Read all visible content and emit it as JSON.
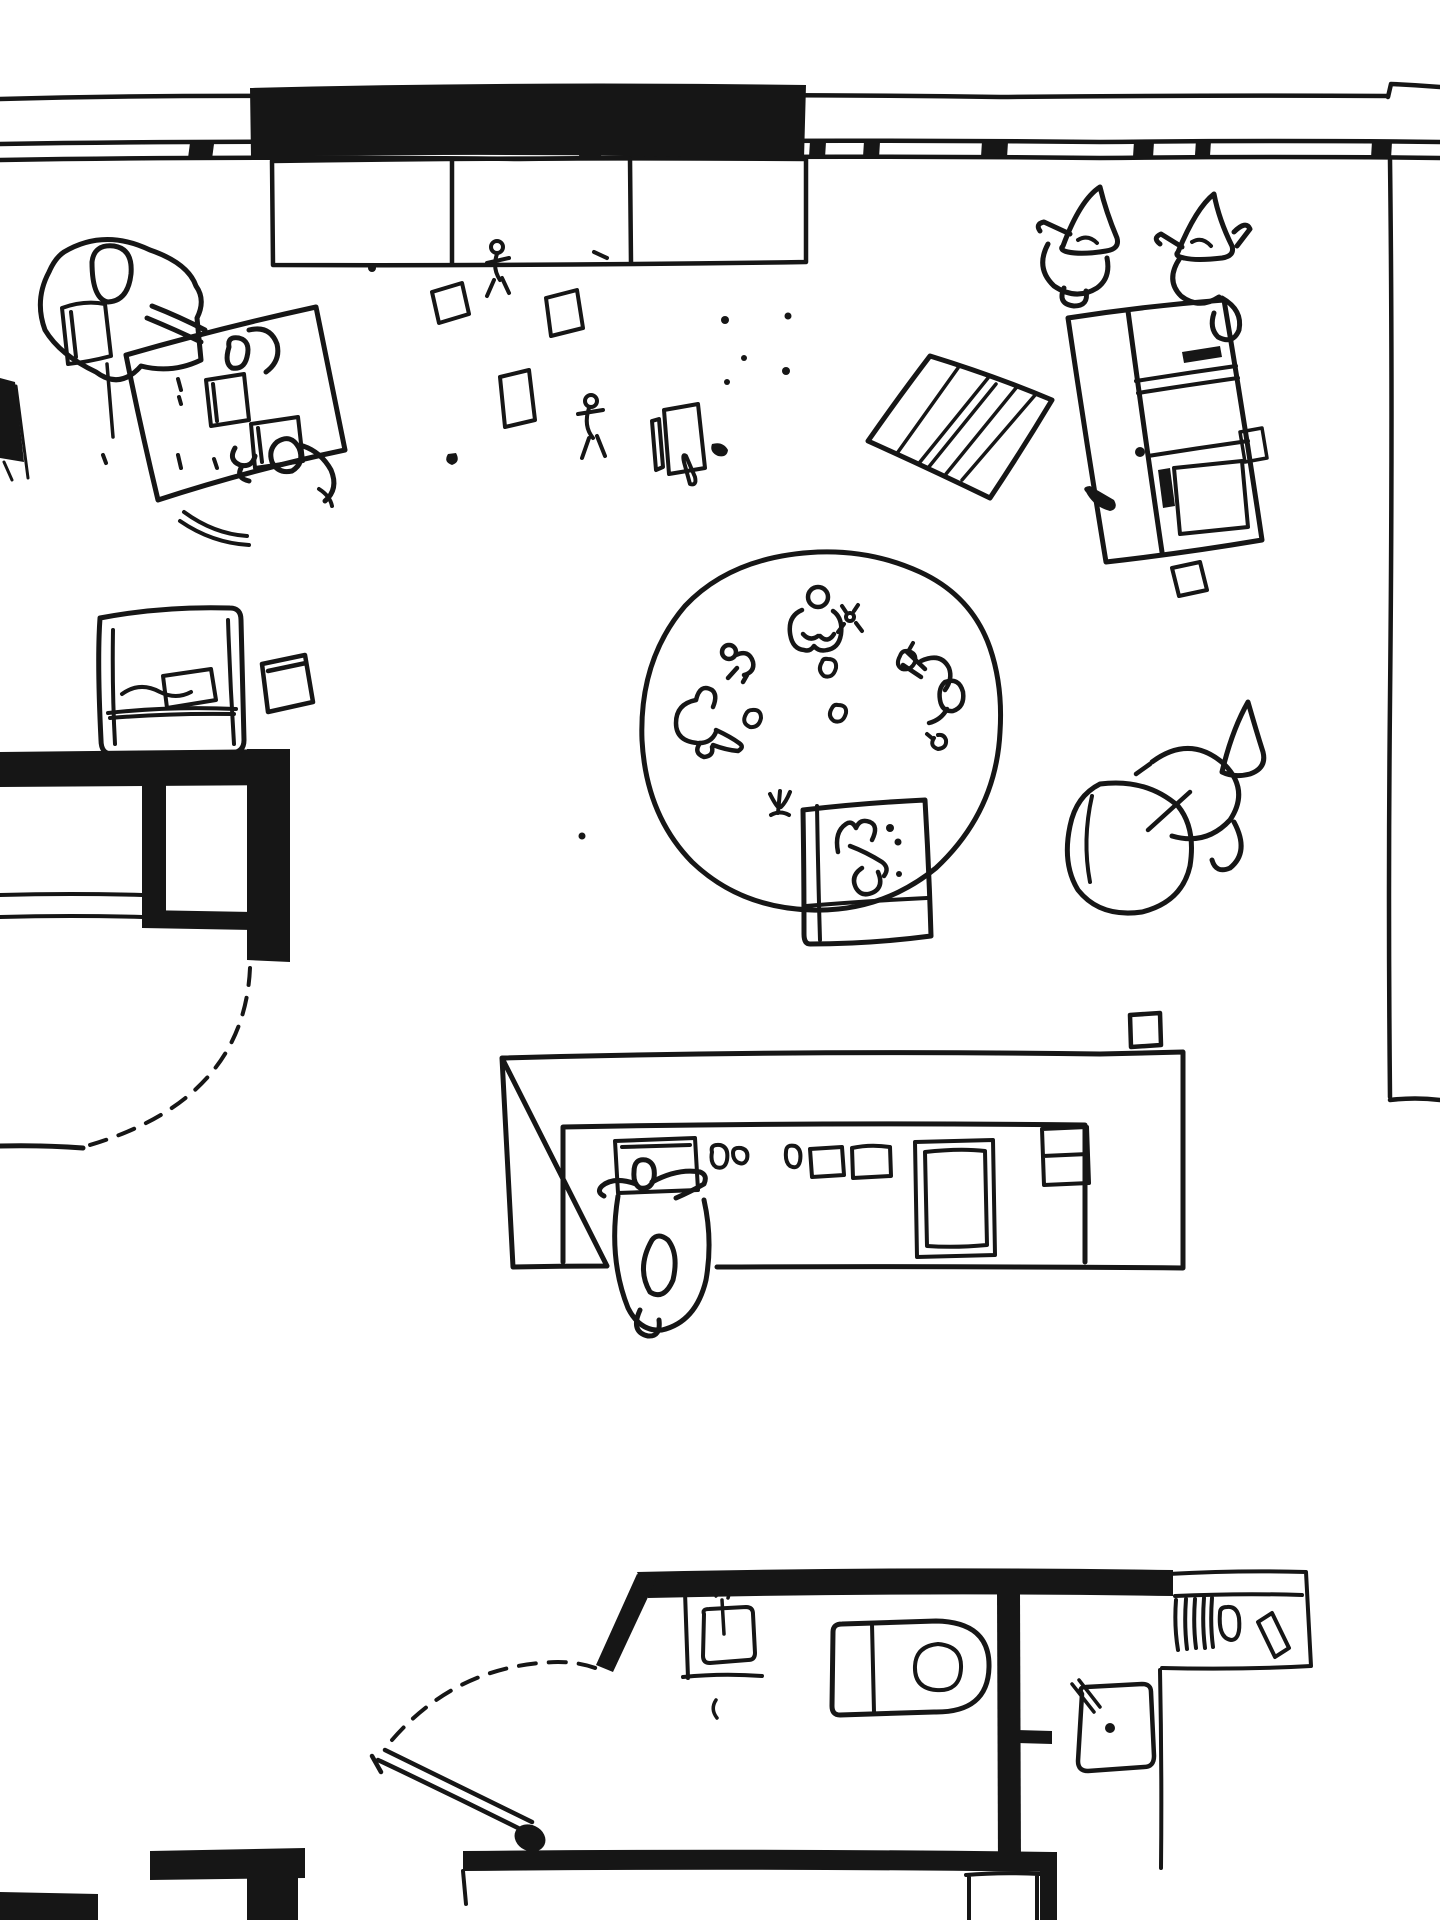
{
  "colors": {
    "ink": "#161616",
    "paper": "#ffffff"
  },
  "canvas": {
    "width": 1440,
    "height": 1920
  },
  "scene": {
    "kind": "hand-drawn floor plan sketch, top view, black ink on white",
    "rooms": [
      "main playroom",
      "left closet nook",
      "bathroom block bottom",
      "storage niche bottom-right"
    ],
    "figure_count": 13,
    "elements": [
      {
        "name": "window-wall",
        "desc": "triple wavy horizontal lines across top with mullion ticks"
      },
      {
        "name": "clerestory-band",
        "desc": "thick solid black band over window bench"
      },
      {
        "name": "window-bench",
        "desc": "three-cell rectangle under black band"
      },
      {
        "name": "desk-group",
        "desc": "tilted table, adult figure with book, two children, chair arcs"
      },
      {
        "name": "scattered-papers",
        "desc": "loose sheets, strips, dots and two small running figures"
      },
      {
        "name": "standing-children-pair",
        "desc": "two children with pointed hoods, top right"
      },
      {
        "name": "striped-mat",
        "desc": "tilted hatched rug"
      },
      {
        "name": "wardrobe-cabinet",
        "desc": "tall tilted cabinet with divider, shelves and black accents"
      },
      {
        "name": "circle-rug",
        "desc": "large round carpet with four children, toys and small objects"
      },
      {
        "name": "floor-mat",
        "desc": "small rectangular mat with lying child at rug edge"
      },
      {
        "name": "beanbag-child",
        "desc": "child reclining on beanbag right of rug"
      },
      {
        "name": "armchair",
        "desc": "square armchair with folded blanket, left side"
      },
      {
        "name": "pillow",
        "desc": "small tilted cushion beside armchair"
      },
      {
        "name": "closet-nook",
        "desc": "thick black L-walls with dashed door swing"
      },
      {
        "name": "kitchen-counter",
        "desc": "long counter with recessed worktop, stove block, bowls and person standing"
      },
      {
        "name": "bathroom-block",
        "desc": "thick walls, diagonal wall, dashed door swing, toilet, two sinks, ladder niche"
      },
      {
        "name": "right-wall",
        "desc": "thin vertical wall line ending in corner turn"
      }
    ]
  }
}
